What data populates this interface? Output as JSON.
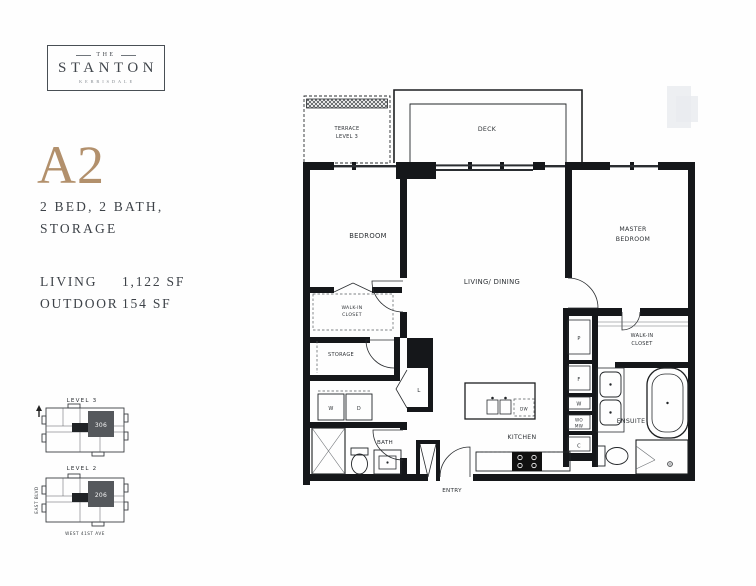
{
  "brand": {
    "the": "THE",
    "name": "STANTON",
    "location": "KERRISDALE"
  },
  "unit": {
    "code": "A2",
    "spec_line1": "2 BED, 2 BATH,",
    "spec_line2": "STORAGE"
  },
  "areas": {
    "living_label": "LIVING",
    "living_value": "1,122 SF",
    "outdoor_label": "OUTDOOR",
    "outdoor_value": "154 SF"
  },
  "floorplan": {
    "labels": {
      "terrace1": "TERRACE",
      "terrace2": "LEVEL 3",
      "deck": "DECK",
      "bedroom": "BEDROOM",
      "master1": "MASTER",
      "master2": "BEDROOM",
      "living": "LIVING/ DINING",
      "walkin1": "WALK-IN",
      "walkin2": "CLOSET",
      "storage": "STORAGE",
      "washer": "W",
      "dryer": "D",
      "bath": "BATH",
      "entry": "ENTRY",
      "kitchen": "KITCHEN",
      "dishwasher": "DW",
      "pantry": "P",
      "fridge": "F",
      "wine": "W",
      "wall_oven": "WO",
      "microwave": "MW",
      "coat_closet": "C",
      "linen": "L",
      "ensuite": "ENSUITE"
    }
  },
  "keyplans": {
    "level3": {
      "title": "LEVEL 3",
      "unit": "306"
    },
    "level2": {
      "title": "LEVEL 2",
      "unit": "206",
      "street_west": "EAST BLVD",
      "street_south": "WEST 41ST AVE"
    }
  },
  "colors": {
    "accent": "#b2906c",
    "ink": "#3d4248",
    "plan_line": "#1d1f21",
    "highlight_unit": "#55585c"
  }
}
